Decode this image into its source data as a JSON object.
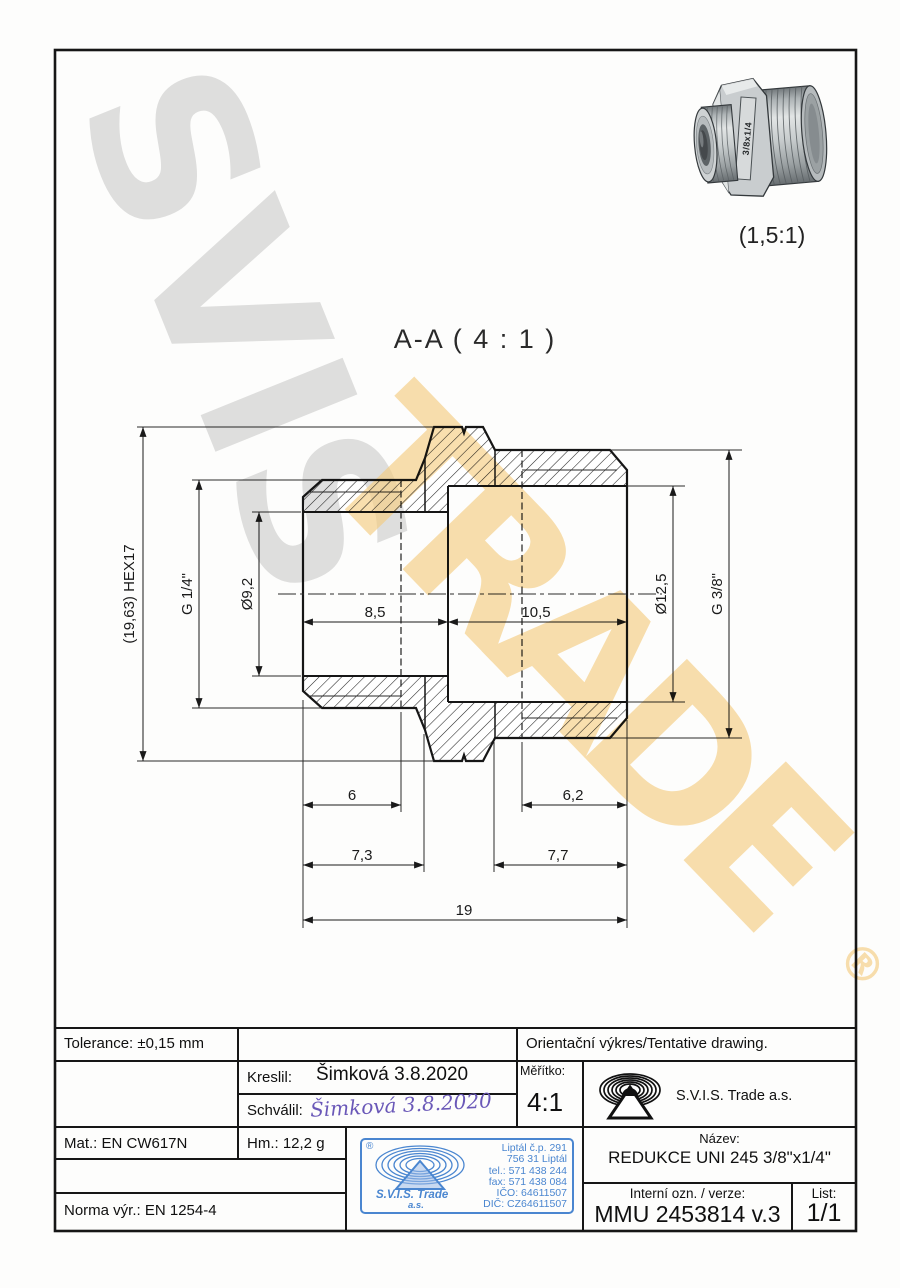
{
  "watermark": {
    "gray": "SVIS",
    "yellow": "TRADE",
    "registered": "®"
  },
  "photo": {
    "scale_label": "(1,5:1)",
    "part_marking": "3/8x1/4"
  },
  "section": {
    "label": "A-A ( 4 : 1 )"
  },
  "dimensions": {
    "hex_height": "(19,63) HEX17",
    "thread_left": "G 1/4\"",
    "bore_left": "Ø9,2",
    "bore_right": "Ø12,5",
    "thread_right": "G 3/8\"",
    "len_left_mid": "8,5",
    "len_right_mid": "10,5",
    "thread_len_left": "6",
    "thread_len_right": "6,2",
    "len_left": "7,3",
    "len_right": "7,7",
    "total_length": "19"
  },
  "title_block": {
    "tolerance": "Tolerance: ±0,15 mm",
    "orientacni": "Orientační výkres/Tentative drawing.",
    "kreslil_label": "Kreslil:",
    "kreslil_value": "Šimková 3.8.2020",
    "schvalil_label": "Schválil:",
    "schvalil_signature": "Šimková 3.8.2020",
    "meritko_label": "Měřítko:",
    "meritko_value": "4:1",
    "company": "S.V.I.S. Trade a.s.",
    "mat": "Mat.: EN CW617N",
    "hm": "Hm.: 12,2 g",
    "norma": "Norma výr.: EN 1254-4",
    "nazev_label": "Název:",
    "nazev_value": "REDUKCE UNI 245 3/8\"x1/4\"",
    "interni_label": "Interní ozn. / verze:",
    "interni_value": "MMU 2453814 v.3",
    "list_label": "List:",
    "list_value": "1/1"
  },
  "stamp": {
    "registered": "®",
    "company": "S.V.I.S. Trade",
    "as": "a.s.",
    "lines": [
      "Liptál č.p. 291",
      "756 31 Liptál",
      "tel.: 571 438 244",
      "fax: 571 438 084",
      "IČO: 64611507",
      "DIČ: CZ64611507"
    ]
  },
  "colors": {
    "stamp_blue": "#4a86d0",
    "signature_purple": "#6a58b8",
    "watermark_gray": "#c3c3c3",
    "watermark_yellow": "#f6cc7c"
  }
}
